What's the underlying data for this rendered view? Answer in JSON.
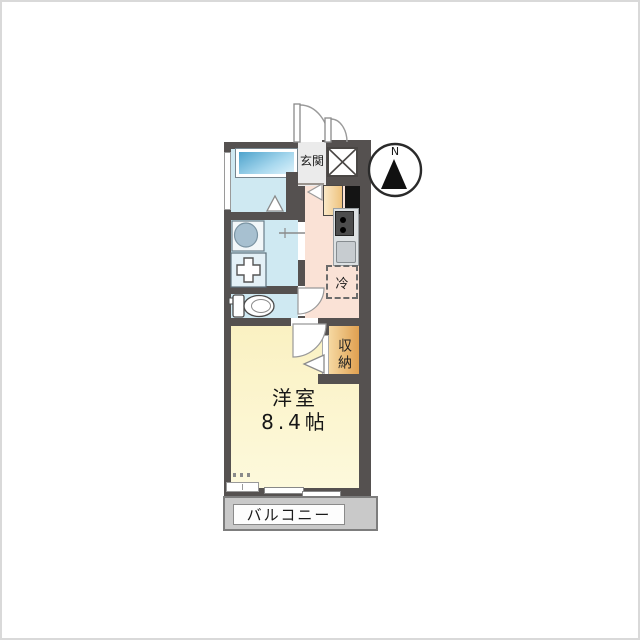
{
  "image_type": "apartment floor plan",
  "compass": {
    "north_label": "N"
  },
  "rooms": {
    "entrance": {
      "label": "玄関"
    },
    "kitchen": {
      "refrigerator_label": "冷"
    },
    "closet": {
      "label": "収納"
    },
    "main_room": {
      "name": "洋室",
      "size": "8.4帖"
    },
    "balcony": {
      "label": "バルコニー"
    }
  },
  "fixtures": [
    "bathtub",
    "washbasin",
    "washing-machine-pan",
    "toilet",
    "gas-stove",
    "kitchen-sink",
    "refrigerator-space",
    "pipe-shaft",
    "entrance-door",
    "room-door",
    "toilet-door",
    "sliding-window",
    "compass"
  ],
  "colors": {
    "wall": "#555150",
    "wet_area_floor": "#cfe9f2",
    "bathtub_blue": "#4ea3cc",
    "kitchen_floor": "#fae2d6",
    "main_room_floor": "#fbf5cd",
    "closet_fill": "#e8b066",
    "balcony_floor": "#c9c9c9",
    "entrance_floor": "#ebebeb"
  }
}
